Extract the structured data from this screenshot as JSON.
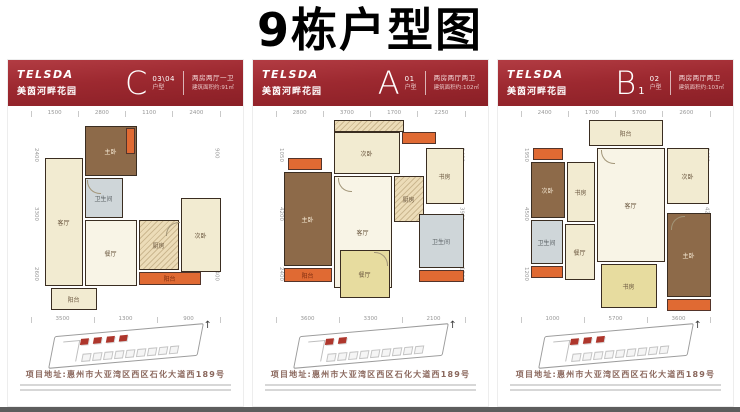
{
  "page": {
    "title": "9栋户型图"
  },
  "brand": {
    "logo": "TELSDA",
    "name": "美茵河畔花园"
  },
  "icons": {
    "north_arrow": "↑"
  },
  "labels": {
    "living": "客厅",
    "dining": "餐厅",
    "master": "主卧",
    "bed2": "次卧",
    "kitchen": "厨房",
    "bath": "卫生间",
    "balcony": "阳台",
    "study": "书房"
  },
  "footer": {
    "address": "项目地址:惠州市大亚湾区西区石化大道西189号"
  },
  "panels": [
    {
      "letter": "C",
      "sub": "",
      "unit": "03\\04",
      "unit_label": "户型",
      "type": "两房两厅一卫",
      "area": "建筑面积约:91㎡",
      "dims_top": [
        "1500",
        "2800",
        "1100",
        "2400"
      ],
      "dims_bottom": [
        "3500",
        "1300",
        "900"
      ],
      "dims_left": [
        "2400",
        "3300",
        "2600"
      ],
      "dims_right": [
        "900",
        "2850",
        "2400"
      ]
    },
    {
      "letter": "A",
      "sub": "",
      "unit": "01",
      "unit_label": "户型",
      "type": "两房两厅两卫",
      "area": "建筑面积约:102㎡",
      "dims_top": [
        "2800",
        "3700",
        "1700",
        "2250"
      ],
      "dims_bottom": [
        "3600",
        "3300",
        "2100"
      ],
      "dims_left": [
        "1050",
        "4200",
        "2400"
      ],
      "dims_right": [
        "2400",
        "3900",
        "1500"
      ]
    },
    {
      "letter": "B",
      "sub": "1",
      "unit": "02",
      "unit_label": "户型",
      "type": "两房两厅两卫",
      "area": "建筑面积约:103㎡",
      "dims_top": [
        "2400",
        "1700",
        "5700",
        "2600"
      ],
      "dims_bottom": [
        "1000",
        "5700",
        "3600"
      ],
      "dims_left": [
        "1950",
        "4500",
        "1200"
      ],
      "dims_right": [
        "2400",
        "4200",
        "2100"
      ]
    }
  ]
}
